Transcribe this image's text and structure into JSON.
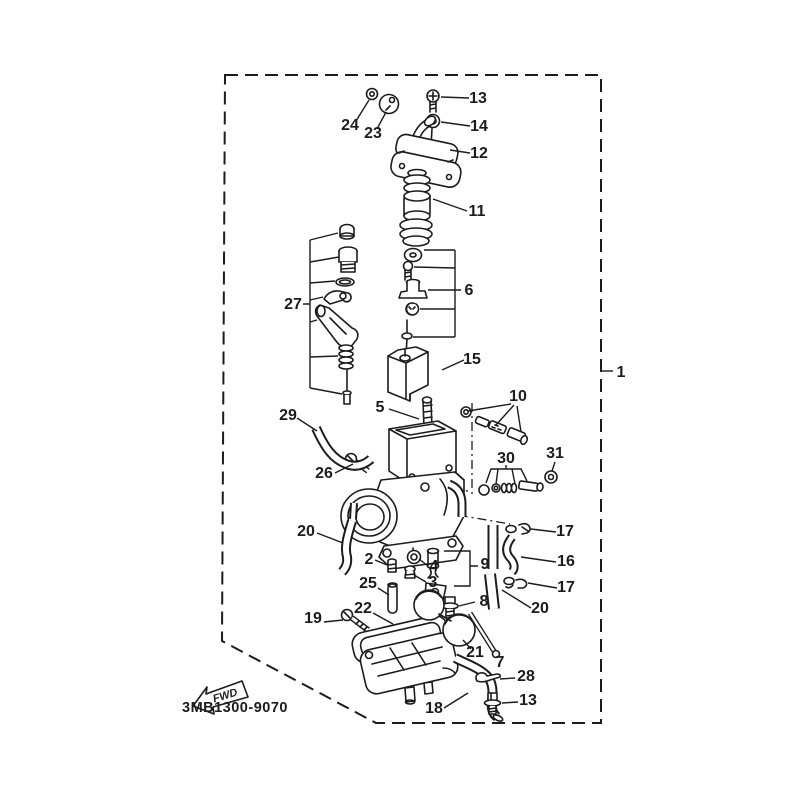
{
  "diagram": {
    "title_code": "3MB1300-9070",
    "fwd_label": "FWD",
    "colors": {
      "line": "#1c1c1c",
      "background": "#ffffff"
    },
    "callouts": [
      {
        "n": "1"
      },
      {
        "n": "24"
      },
      {
        "n": "23"
      },
      {
        "n": "13"
      },
      {
        "n": "14"
      },
      {
        "n": "12"
      },
      {
        "n": "11"
      },
      {
        "n": "6"
      },
      {
        "n": "27"
      },
      {
        "n": "15"
      },
      {
        "n": "5"
      },
      {
        "n": "29"
      },
      {
        "n": "26"
      },
      {
        "n": "10"
      },
      {
        "n": "30"
      },
      {
        "n": "31"
      },
      {
        "n": "20"
      },
      {
        "n": "2"
      },
      {
        "n": "25"
      },
      {
        "n": "4"
      },
      {
        "n": "3"
      },
      {
        "n": "9"
      },
      {
        "n": "8"
      },
      {
        "n": "17"
      },
      {
        "n": "16"
      },
      {
        "n": "17"
      },
      {
        "n": "20"
      },
      {
        "n": "22"
      },
      {
        "n": "19"
      },
      {
        "n": "21"
      },
      {
        "n": "7"
      },
      {
        "n": "28"
      },
      {
        "n": "18"
      },
      {
        "n": "13"
      }
    ]
  }
}
